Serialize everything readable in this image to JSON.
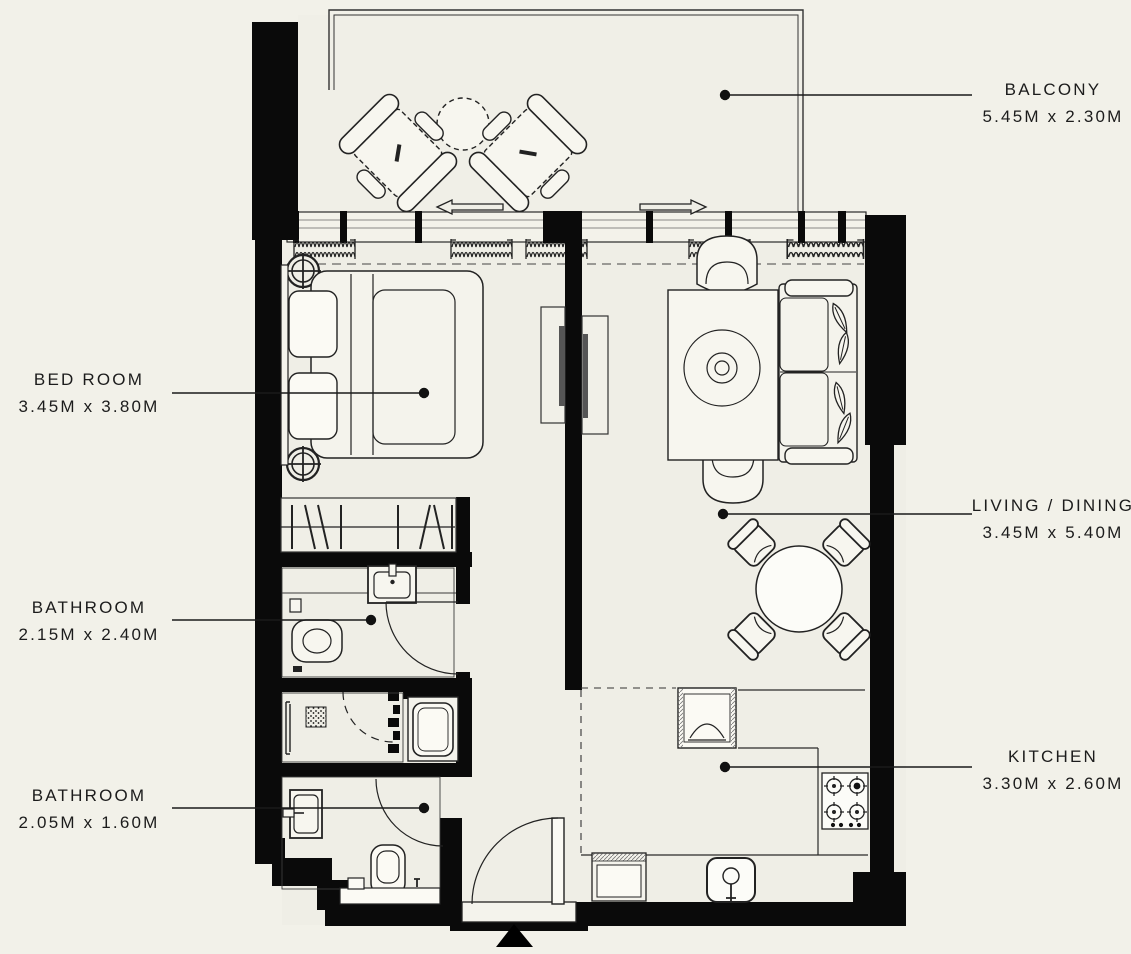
{
  "page": {
    "type": "apartment-floor-plan",
    "background_color": "#f2f1e9",
    "wall_color": "#0a0a0a",
    "line_color": "#1a1a1a",
    "floor_color": "#efeee6"
  },
  "rooms": [
    {
      "id": "balcony",
      "name": "BALCONY",
      "dimensions": "5.45M x 2.30M",
      "label_side": "right"
    },
    {
      "id": "bed-room",
      "name": "BED ROOM",
      "dimensions": "3.45M x 3.80M",
      "label_side": "left"
    },
    {
      "id": "living-dining",
      "name": "LIVING / DINING",
      "dimensions": "3.45M x 5.40M",
      "label_side": "right"
    },
    {
      "id": "bathroom-1",
      "name": "BATHROOM",
      "dimensions": "2.15M x 2.40M",
      "label_side": "left"
    },
    {
      "id": "bathroom-2",
      "name": "BATHROOM",
      "dimensions": "2.05M x 1.60M",
      "label_side": "left"
    },
    {
      "id": "kitchen",
      "name": "KITCHEN",
      "dimensions": "3.30M x 2.60M",
      "label_side": "right"
    }
  ],
  "furniture_icons": [
    "double-bed",
    "pillow",
    "bedside-lamp",
    "tv-unit",
    "closet-rail",
    "sofa",
    "leaf-cushion",
    "coffee-table",
    "armchair",
    "dining-table",
    "dining-chair",
    "lounge-chair",
    "balcony-table",
    "toilet",
    "wash-basin",
    "shower-drain",
    "washing-machine",
    "fridge",
    "gas-hob",
    "kitchen-sink",
    "dishwasher"
  ],
  "symbols": {
    "entry_marker": "entrance-triangle",
    "sliding_door_arrows": [
      "left",
      "right"
    ],
    "curtain_symbol": "coil-spring",
    "door_symbol": "quarter-arc-swing"
  }
}
